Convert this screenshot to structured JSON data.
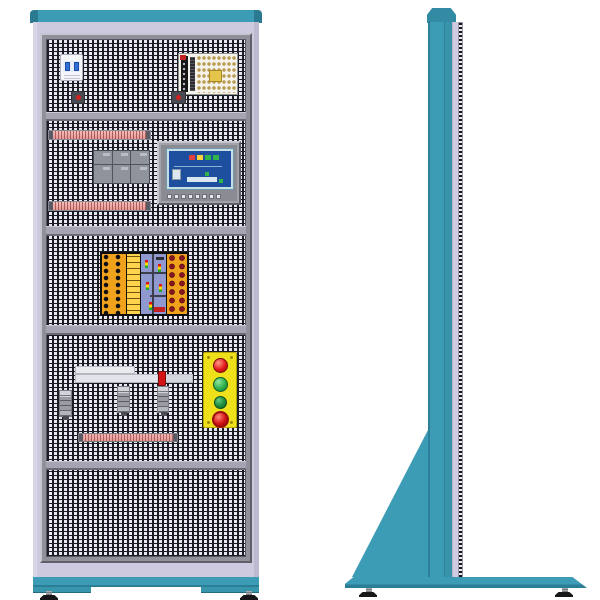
{
  "illustration": {
    "title": "Industrial control training cabinet",
    "description": "Vector illustration of an electrical control cabinet: front elevation on the left, side elevation on the right",
    "background_color": "#ffffff"
  },
  "palette": {
    "teal": "#3d9cb5",
    "teal_dark": "#2c7e96",
    "cabinet_body_lavender": "#cdc9de",
    "frame_gray": "#90909a",
    "mesh_background": "#e9e7f3",
    "mesh_line": "#1b1b22",
    "rail_gray": "#a6a4b2",
    "wiring_duct_pink": "#efaead",
    "hmi_screen_blue": "#1d4f9e",
    "hmi_frame_cyan": "#c4dde6",
    "board_orange": "#f0a21c",
    "board_yellow": "#ffd34d",
    "board_pcb_lilac": "#8f98cf",
    "socket_dark_red": "#6b0f1a",
    "station_yellow": "#efe01c",
    "pilot_red": "#e21818",
    "button_green": "#2fae4a",
    "button_green_dark": "#1d8a3c",
    "estop_red": "#d41414",
    "psu_board_white": "#f4f2ea",
    "breaker_toggle_blue": "#2f6fd6",
    "foot_black": "#17171a"
  },
  "front_view": {
    "label": "front elevation",
    "sections": [
      {
        "name": "supply section",
        "components": [
          "2-pole miniature circuit breaker",
          "switch-mode power supply board",
          "small pilot device",
          "small pilot device"
        ]
      },
      {
        "name": "controller section",
        "components": [
          "wiring duct",
          "plc module assembly",
          "hmi touch panel",
          "wiring duct"
        ]
      },
      {
        "name": "trainer board section",
        "components": [
          "i/o trainer board with terminal strip, label strip, pcb with traffic-light graphics and banana-socket strip"
        ]
      },
      {
        "name": "operator section",
        "components": [
          "slide rail",
          "red stop block",
          "sensor",
          "sensor",
          "sensor",
          "pushbutton station",
          "terminal strip"
        ]
      },
      {
        "name": "vent section",
        "components": []
      }
    ],
    "pushbutton_station": {
      "panel_color": "#efe01c",
      "devices": [
        {
          "name": "red pilot light",
          "color": "#e21818"
        },
        {
          "name": "green pushbutton",
          "color": "#2fae4a"
        },
        {
          "name": "green pushbutton",
          "color": "#1d8a3c"
        },
        {
          "name": "emergency stop mushroom button",
          "color": "#d41414"
        }
      ]
    },
    "hmi_panel": {
      "screen_color": "#1d4f9e",
      "indicator_colors": [
        "#e24040",
        "#ffd23a",
        "#2fb34a",
        "#2fb34a"
      ],
      "function_key_count": 8
    },
    "trainer_board": {
      "left_terminal_columns": 2,
      "left_terminal_rows": 8,
      "right_socket_columns": 2,
      "right_socket_rows": 7
    },
    "leveling_feet": 2
  },
  "side_view": {
    "label": "side elevation",
    "features": [
      "beveled top cap",
      "upright teal column",
      "louvered vent strip",
      "triangular support gusset",
      "base plate",
      "leveling feet"
    ],
    "leveling_feet": 2
  }
}
